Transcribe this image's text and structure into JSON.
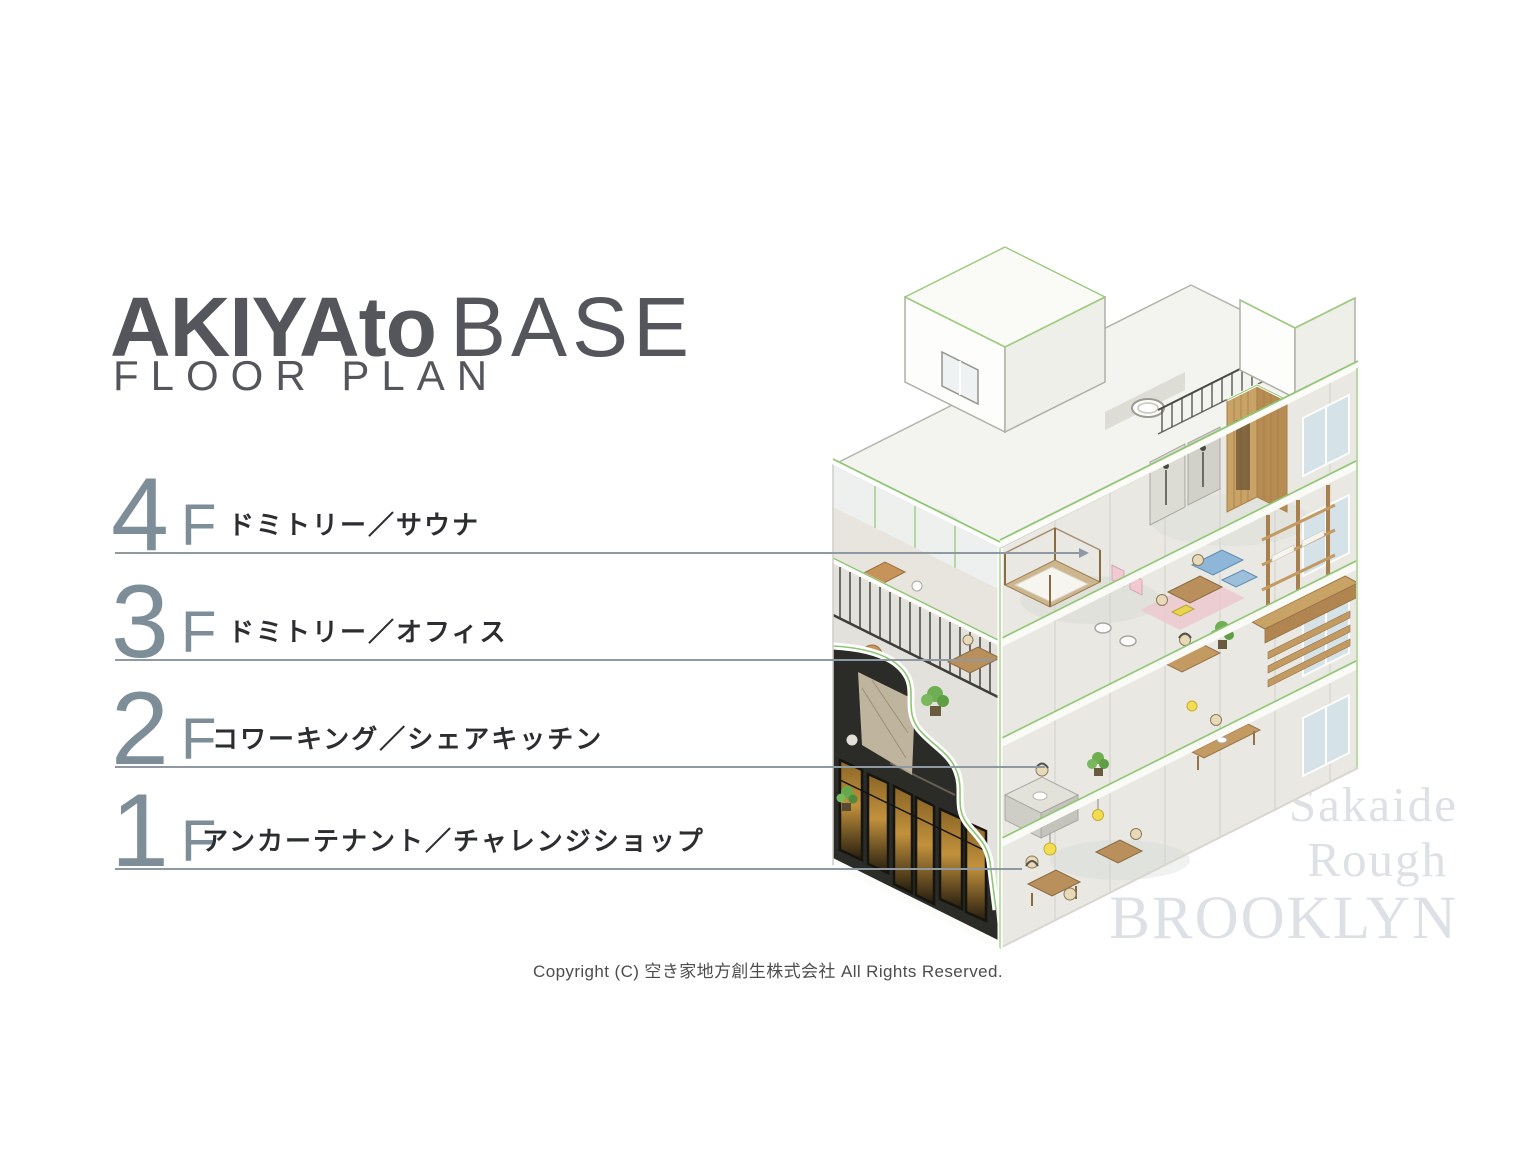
{
  "slide": {
    "title": {
      "brand_bold": "AKIYAto",
      "brand_light": "BASE",
      "subtitle": "FLOOR PLAN"
    },
    "floors": [
      {
        "num": "4",
        "suffix": "F",
        "label": "ドミトリー／サウナ"
      },
      {
        "num": "3",
        "suffix": "F",
        "label": "ドミトリー／オフィス"
      },
      {
        "num": "2",
        "suffix": "F",
        "label": "コワーキング／シェアキッチン"
      },
      {
        "num": "1",
        "suffix": "F",
        "label": "アンカーテナント／チャレンジショップ"
      }
    ],
    "watermark": {
      "line1": "Sakaide",
      "line2": "Rough",
      "line3": "BROOKLYN"
    },
    "copyright": "Copyright (C) 空き家地方創生株式会社 All Rights Reserved.",
    "colors": {
      "accent_green": "#8fc573",
      "floor_number": "#7e8e99",
      "leader_line": "#8e99a2",
      "title_text": "#54565b",
      "label_text": "#2b2d30",
      "watermark_text": "#dde1e5",
      "storefront_dark": "#2b2b27",
      "window_glow": "#c2913c",
      "wood": "#c49a63"
    }
  }
}
